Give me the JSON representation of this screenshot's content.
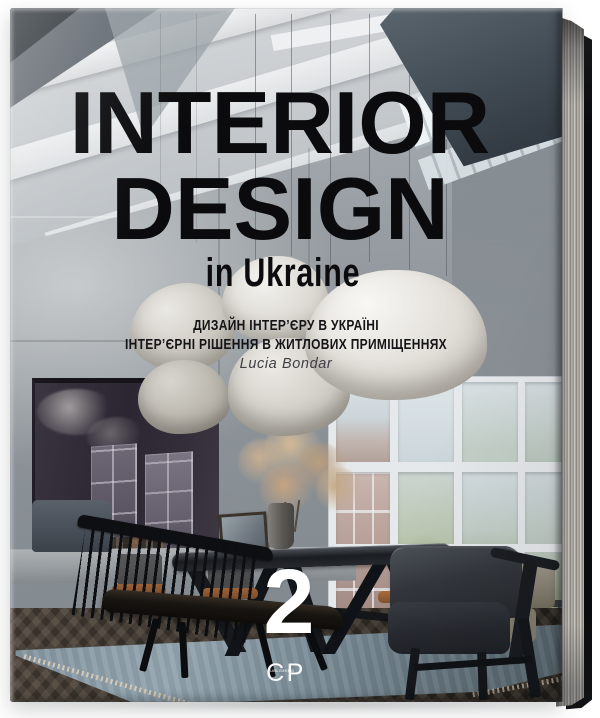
{
  "book": {
    "cover": {
      "title_line1": "INTERIOR",
      "title_line2": "DESIGN",
      "subtitle": "in Ukraine",
      "tagline_line1": "ДИЗАЙН ІНТЕР’ЄРУ В УКРАЇНІ",
      "tagline_line2": "ІНТЕР’ЄРНІ РІШЕННЯ В ЖИТЛОВИХ ПРИМІЩЕННЯХ",
      "author": "Lucia Bondar",
      "volume_number": "2",
      "publisher_logo": "CP",
      "publisher_logo_subtext": "PUBLISHING"
    },
    "colors": {
      "title_ink": "#0b0b0d",
      "volume_ink": "#ffffff",
      "cover_concrete": "#989ea3",
      "page_edge": "#b3b0aa",
      "back_cover": "#0d0d0f"
    }
  }
}
